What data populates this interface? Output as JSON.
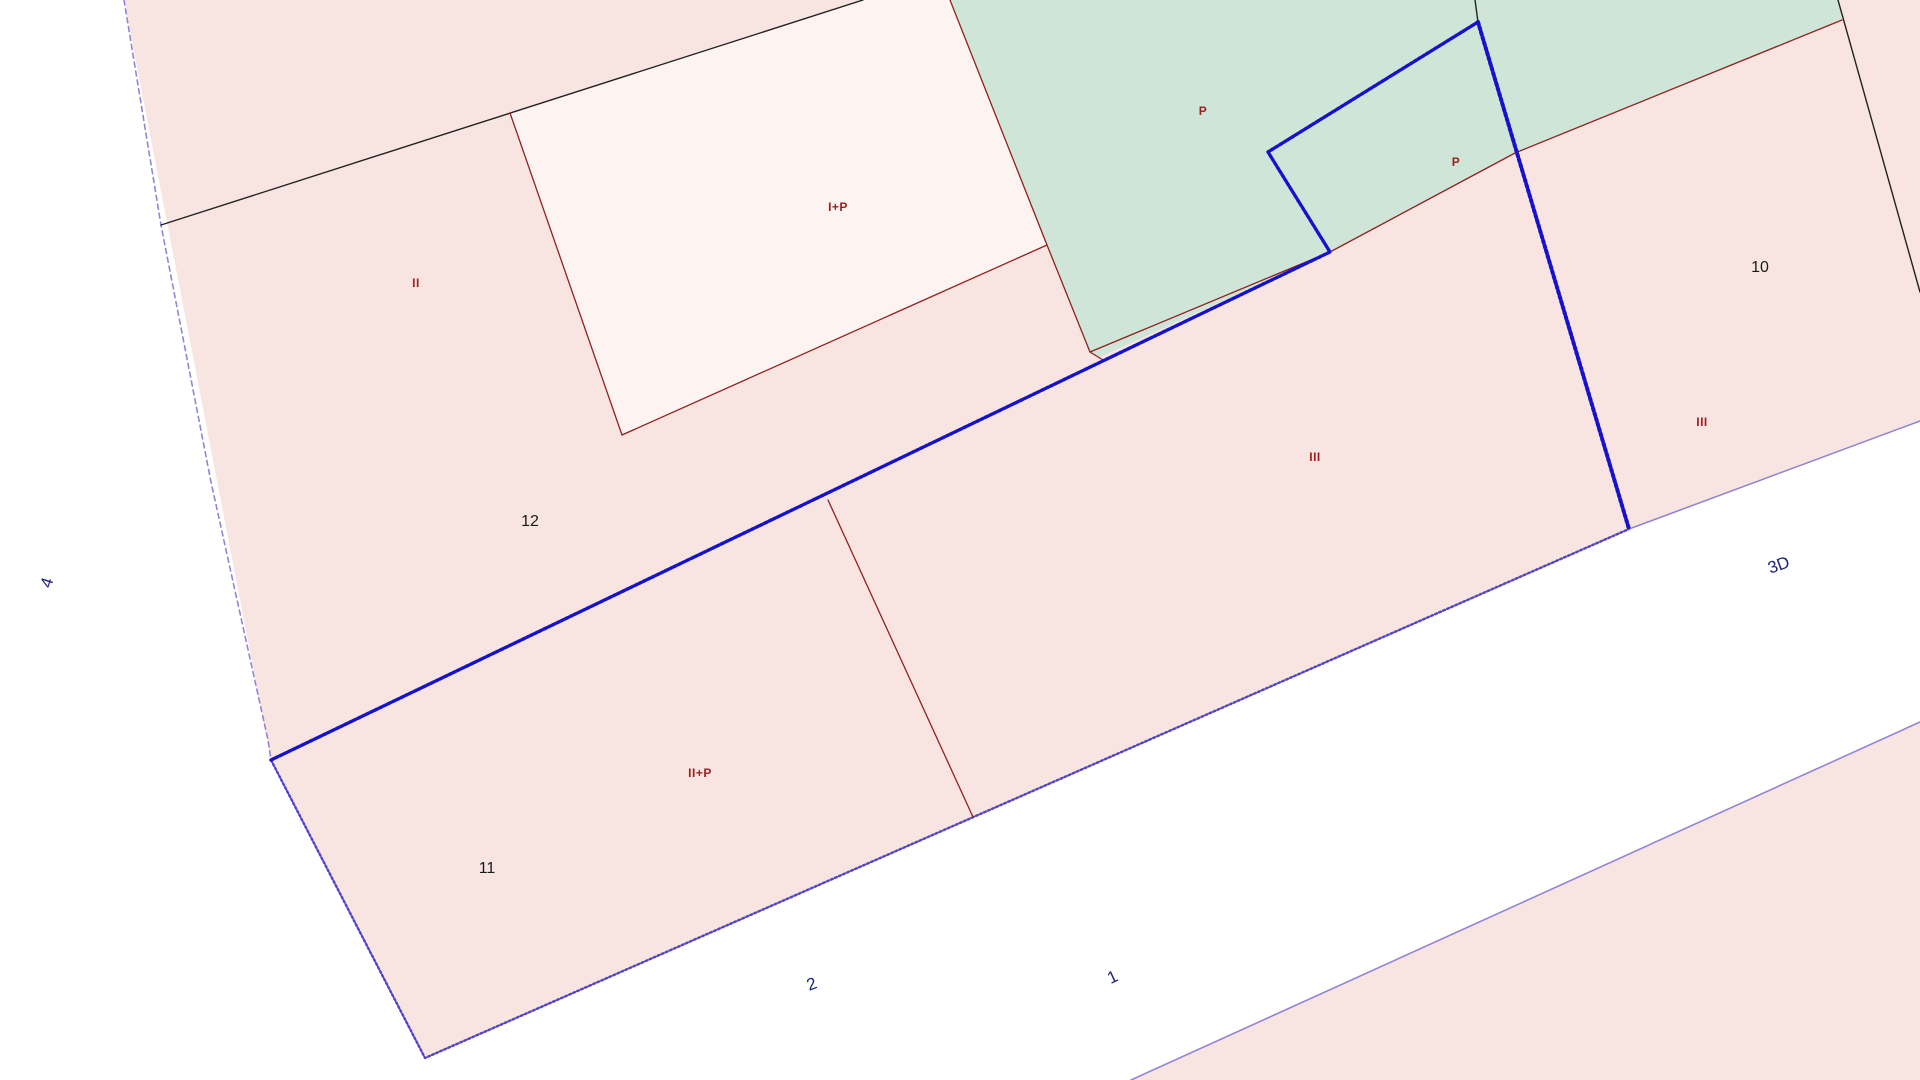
{
  "map": {
    "width": 1920,
    "height": 1080,
    "colors": {
      "background": "#ffffff",
      "parcel_pink": "#f8e5e2",
      "parcel_green": "#cee5d7",
      "building_light": "#fdf3f1",
      "road_white": "#ffffff",
      "line_black": "#222222",
      "line_red": "#8f2121",
      "line_blue": "#1611cb",
      "line_violet_dash": "#9285d5",
      "line_stipple": "#5145c6",
      "text_storey": "#a02020",
      "text_parcel": "#1a1a1a",
      "text_road": "#22227a"
    },
    "polygons": [
      {
        "name": "parcel-block-pink",
        "fill": "parcel_pink",
        "points": [
          [
            124,
            0
          ],
          [
            1920,
            0
          ],
          [
            1920,
            421
          ],
          [
            1629,
            529
          ],
          [
            425,
            1058
          ],
          [
            271,
            760
          ]
        ]
      },
      {
        "name": "parcel-green-area",
        "fill": "parcel_green",
        "points": [
          [
            950,
            0
          ],
          [
            1838,
            0
          ],
          [
            1842,
            20
          ],
          [
            1515,
            153
          ],
          [
            1330,
            252
          ],
          [
            1100,
            357
          ],
          [
            1090,
            352
          ],
          [
            1047,
            245
          ]
        ]
      },
      {
        "name": "building-footprint-ip",
        "fill": "building_light",
        "points": [
          [
            510,
            113
          ],
          [
            863,
            0
          ],
          [
            950,
            0
          ],
          [
            1047,
            245
          ],
          [
            622,
            435
          ]
        ]
      },
      {
        "name": "parcel-bottom-right-pink",
        "fill": "parcel_pink",
        "points": [
          [
            1131,
            1080
          ],
          [
            1920,
            722
          ],
          [
            1920,
            1080
          ]
        ]
      }
    ],
    "lines": [
      {
        "name": "boundary-violet-dashed-left",
        "stroke": "line_violet_dash",
        "width": 1.6,
        "dash": "5 4",
        "points": [
          [
            124,
            0
          ],
          [
            161,
            225
          ],
          [
            211,
            482
          ],
          [
            268,
            740
          ],
          [
            271,
            760
          ]
        ]
      },
      {
        "name": "road-edge-stippled-nw",
        "stroke": "line_stipple",
        "width": 2.4,
        "dash": "2 2.4",
        "points": [
          [
            271,
            760
          ],
          [
            425,
            1058
          ],
          [
            1629,
            529
          ]
        ]
      },
      {
        "name": "road-edge-thin-ne",
        "stroke": "line_violet_dash",
        "width": 1.6,
        "dash": "",
        "points": [
          [
            1629,
            529
          ],
          [
            1920,
            421
          ]
        ]
      },
      {
        "name": "road-edge-thin-se",
        "stroke": "line_violet_dash",
        "width": 1.6,
        "dash": "",
        "points": [
          [
            1131,
            1080
          ],
          [
            1920,
            722
          ]
        ]
      },
      {
        "name": "boundary-black-diagonal",
        "stroke": "line_black",
        "width": 1.4,
        "dash": "",
        "points": [
          [
            161,
            225
          ],
          [
            863,
            0
          ]
        ]
      },
      {
        "name": "boundary-black-top-vertical",
        "stroke": "line_black",
        "width": 1.4,
        "dash": "",
        "points": [
          [
            1475,
            0
          ],
          [
            1478,
            22
          ]
        ]
      },
      {
        "name": "boundary-black-right",
        "stroke": "line_black",
        "width": 1.4,
        "dash": "",
        "points": [
          [
            1838,
            0
          ],
          [
            1920,
            292
          ]
        ]
      },
      {
        "name": "parcel-line-red-building-left",
        "stroke": "line_red",
        "width": 1.3,
        "dash": "",
        "points": [
          [
            510,
            113
          ],
          [
            622,
            435
          ]
        ]
      },
      {
        "name": "parcel-line-red-building-bottom",
        "stroke": "line_red",
        "width": 1.3,
        "dash": "",
        "points": [
          [
            622,
            435
          ],
          [
            1047,
            245
          ]
        ]
      },
      {
        "name": "parcel-line-red-green-west",
        "stroke": "line_red",
        "width": 1.3,
        "dash": "",
        "points": [
          [
            950,
            0
          ],
          [
            1047,
            245
          ],
          [
            1090,
            352
          ],
          [
            1103,
            360
          ]
        ]
      },
      {
        "name": "parcel-line-red-green-south",
        "stroke": "line_red",
        "width": 1.3,
        "dash": "",
        "points": [
          [
            1090,
            352
          ],
          [
            1330,
            252
          ],
          [
            1515,
            153
          ],
          [
            1842,
            20
          ]
        ]
      },
      {
        "name": "parcel-line-red-mid-divider",
        "stroke": "line_red",
        "width": 1.3,
        "dash": "",
        "points": [
          [
            828,
            500
          ],
          [
            973,
            817
          ]
        ]
      },
      {
        "name": "selected-boundary-blue-main",
        "stroke": "line_blue",
        "width": 3.4,
        "dash": "3 1.8",
        "points": [
          [
            271,
            760
          ],
          [
            1330,
            252
          ],
          [
            1268,
            152
          ],
          [
            1478,
            22
          ]
        ]
      },
      {
        "name": "selected-boundary-blue-vertical",
        "stroke": "line_blue",
        "width": 4,
        "dash": "2.5 2.8",
        "points": [
          [
            1478,
            22
          ],
          [
            1629,
            529
          ]
        ]
      }
    ],
    "labels": [
      {
        "name": "storey-label-ii",
        "text": "II",
        "x": 416,
        "y": 284,
        "rotate": 0,
        "kind": "storey"
      },
      {
        "name": "storey-label-i-p",
        "text": "I+P",
        "x": 838,
        "y": 208,
        "rotate": 0,
        "kind": "storey"
      },
      {
        "name": "storey-label-p-green",
        "text": "P",
        "x": 1203,
        "y": 112,
        "rotate": 0,
        "kind": "storey"
      },
      {
        "name": "storey-label-p-small",
        "text": "P",
        "x": 1456,
        "y": 163,
        "rotate": 0,
        "kind": "storey"
      },
      {
        "name": "storey-label-iii-mid",
        "text": "III",
        "x": 1315,
        "y": 458,
        "rotate": 0,
        "kind": "storey"
      },
      {
        "name": "storey-label-iii-right",
        "text": "III",
        "x": 1702,
        "y": 423,
        "rotate": 0,
        "kind": "storey"
      },
      {
        "name": "storey-label-ii-p",
        "text": "II+P",
        "x": 700,
        "y": 774,
        "rotate": 0,
        "kind": "storey"
      },
      {
        "name": "parcel-number-12",
        "text": "12",
        "x": 530,
        "y": 522,
        "rotate": 0,
        "kind": "parcel"
      },
      {
        "name": "parcel-number-11",
        "text": "11",
        "x": 487,
        "y": 869,
        "rotate": 0,
        "kind": "parcel"
      },
      {
        "name": "parcel-number-10",
        "text": "10",
        "x": 1760,
        "y": 268,
        "rotate": 0,
        "kind": "parcel"
      },
      {
        "name": "road-label-4",
        "text": "4",
        "x": 48,
        "y": 583,
        "rotate": -72,
        "kind": "road"
      },
      {
        "name": "road-label-2",
        "text": "2",
        "x": 812,
        "y": 985,
        "rotate": -20,
        "kind": "road"
      },
      {
        "name": "road-label-1",
        "text": "1",
        "x": 1113,
        "y": 978,
        "rotate": -25,
        "kind": "road"
      },
      {
        "name": "road-label-3d",
        "text": "3D",
        "x": 1779,
        "y": 566,
        "rotate": -20,
        "kind": "road"
      }
    ]
  }
}
